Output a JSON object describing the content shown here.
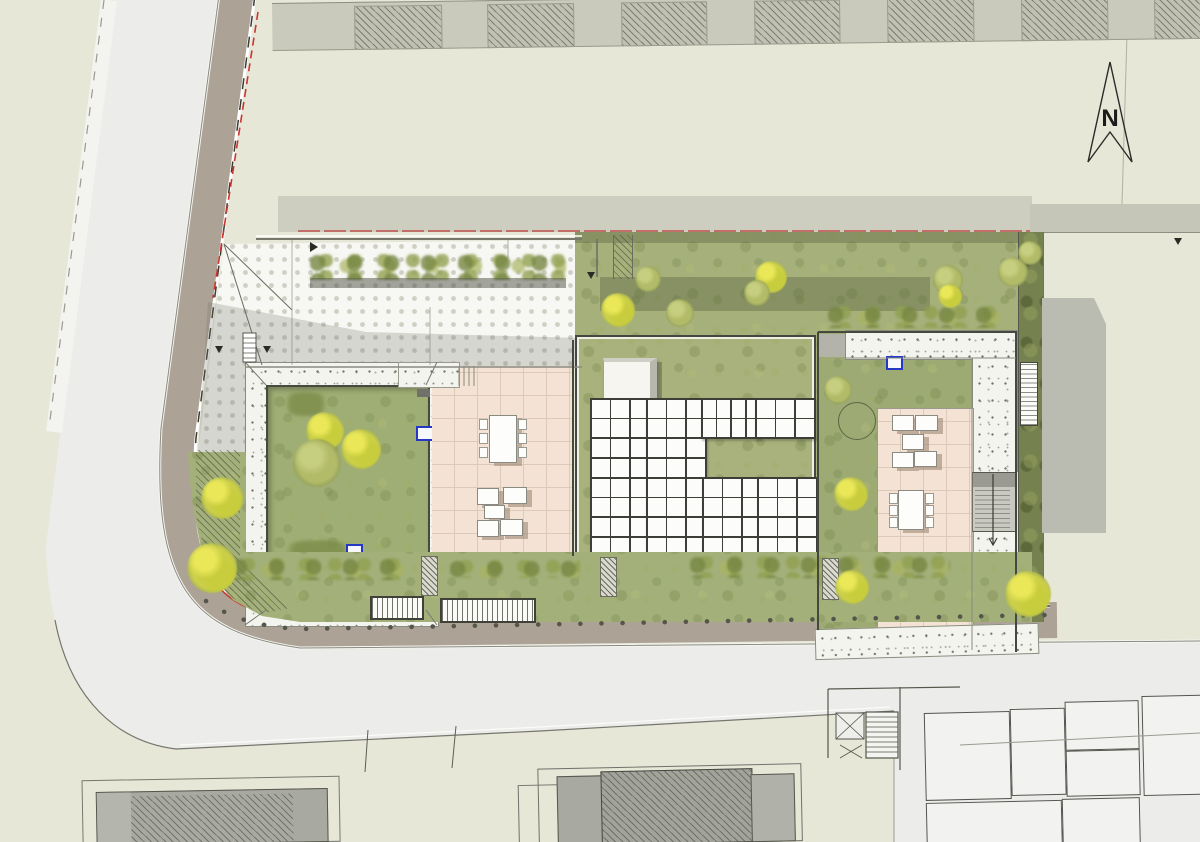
{
  "meta": {
    "drawing_type": "architectural roof / site plan",
    "visible_text_items": 1
  },
  "north_arrow": {
    "label": "N"
  },
  "colors": {
    "bg_beige": "#e7e7d8",
    "road_gray": "#ececeb",
    "sidewalk_taupe": "#aca295",
    "grass_green": "#a6b07b",
    "roof_green": "#a9b17c",
    "gravel_white": "#f4f4ee",
    "pave_white": "#f7f7f3",
    "terrace_pink": "#f4e3d4",
    "panel_white": "#fcfcfa",
    "panel_frame": "#3d3e37",
    "tree_yellow": "#ccd04a",
    "tree_olive": "#b2bb68",
    "dark_strip_olive": "#75814e",
    "boundary_red": "#cc3430",
    "skylight_blue": "#2438c4",
    "building_line": "#45483e",
    "neighbor_roof_gray": "#a8a9a0"
  },
  "solar_roof": {
    "panel_size": 18,
    "groups": [
      {
        "x": 590,
        "y": 398,
        "cols": 3,
        "rows": 4
      },
      {
        "x": 646,
        "y": 398,
        "cols": 3,
        "rows": 4
      },
      {
        "x": 701,
        "y": 398,
        "cols": 4,
        "rows": 2,
        "pw": 13
      },
      {
        "x": 755,
        "y": 398,
        "cols": 3,
        "rows": 2
      },
      {
        "x": 590,
        "y": 477,
        "cols": 3,
        "rows": 4
      },
      {
        "x": 646,
        "y": 477,
        "cols": 3,
        "rows": 4
      },
      {
        "x": 702,
        "y": 477,
        "cols": 3,
        "rows": 4
      },
      {
        "x": 757,
        "y": 477,
        "cols": 3,
        "rows": 4
      }
    ]
  },
  "vegetation": {
    "trees": [
      {
        "x": 325,
        "y": 431,
        "r": 19,
        "t": "yellow"
      },
      {
        "x": 361,
        "y": 449,
        "r": 20,
        "t": "yellow"
      },
      {
        "x": 317,
        "y": 463,
        "r": 24,
        "t": "olive"
      },
      {
        "x": 618,
        "y": 310,
        "r": 17,
        "t": "yellow"
      },
      {
        "x": 648,
        "y": 279,
        "r": 13,
        "t": "olive"
      },
      {
        "x": 680,
        "y": 313,
        "r": 14,
        "t": "olive"
      },
      {
        "x": 771,
        "y": 277,
        "r": 16,
        "t": "yellow"
      },
      {
        "x": 757,
        "y": 293,
        "r": 13,
        "t": "olive"
      },
      {
        "x": 948,
        "y": 280,
        "r": 15,
        "t": "olive"
      },
      {
        "x": 950,
        "y": 296,
        "r": 12,
        "t": "yellow"
      },
      {
        "x": 1013,
        "y": 272,
        "r": 15,
        "t": "olive"
      },
      {
        "x": 1030,
        "y": 253,
        "r": 12,
        "t": "olive"
      },
      {
        "x": 222,
        "y": 498,
        "r": 21,
        "t": "yellow"
      },
      {
        "x": 212,
        "y": 568,
        "r": 25,
        "t": "yellow"
      },
      {
        "x": 838,
        "y": 390,
        "r": 14,
        "t": "olive"
      },
      {
        "x": 851,
        "y": 494,
        "r": 17,
        "t": "yellow"
      },
      {
        "x": 852,
        "y": 587,
        "r": 17,
        "t": "yellow"
      },
      {
        "x": 1028,
        "y": 594,
        "r": 23,
        "t": "yellow"
      }
    ]
  }
}
